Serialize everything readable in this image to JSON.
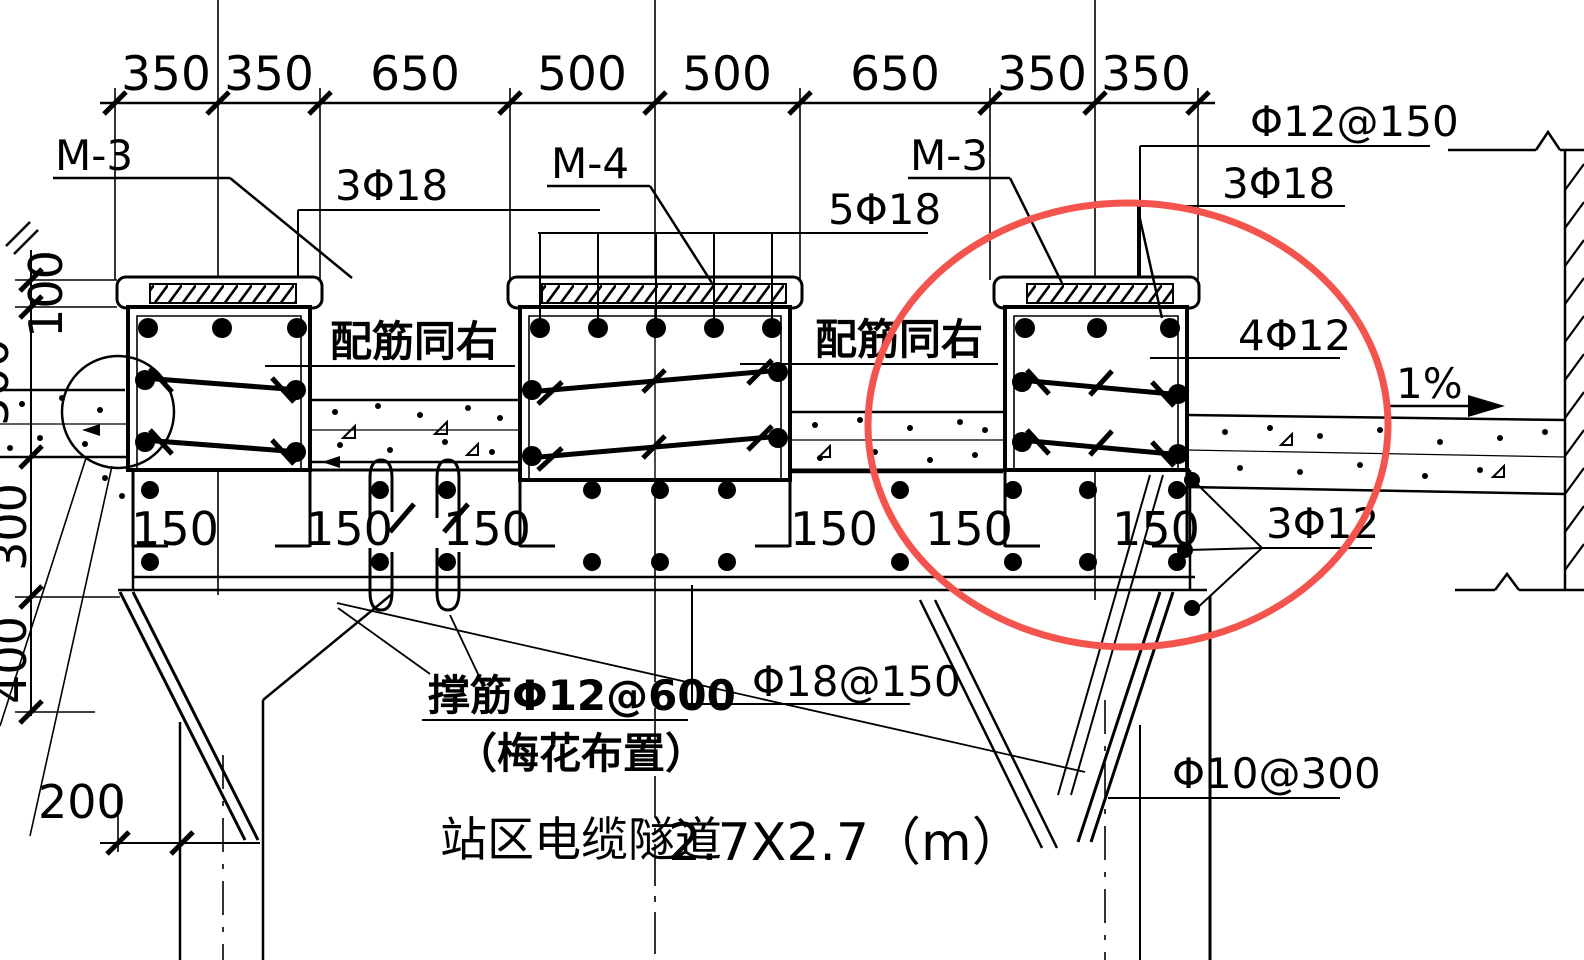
{
  "drawing": {
    "type": "structural-section",
    "title_cn": "站区电缆隧道",
    "title_size": "2.7X2.7（m）",
    "dims": {
      "top": [
        "350",
        "350",
        "650",
        "500",
        "500",
        "650",
        "350",
        "350"
      ],
      "left": [
        "100",
        "500",
        "300",
        "400"
      ],
      "offset_bottom_left": "200",
      "spacing": [
        "150",
        "150",
        "150",
        "150",
        "150",
        "150"
      ]
    },
    "beam_labels": {
      "left": "M-3",
      "middle": "M-4",
      "right": "M-3"
    },
    "rebar": {
      "top_left_beam": "3Φ18",
      "top_middle_beam": "5Φ18",
      "top_right_beam": "3Φ18",
      "plate_mesh": "Φ12@150",
      "same_as_right_left": "配筋同右",
      "same_as_right_right": "配筋同右",
      "beam_side_bars": "4Φ12",
      "beam_bottom_bars": "3Φ12",
      "slab_bottom_bars": "Φ18@150",
      "chair_bars": "撑筋Φ12@600",
      "chair_bars_note": "（梅花布置）",
      "wall_bars": "Φ10@300",
      "slope": "1%"
    },
    "colors": {
      "line": "#000000",
      "highlight": "#f4544e",
      "background": "#ffffff"
    }
  }
}
